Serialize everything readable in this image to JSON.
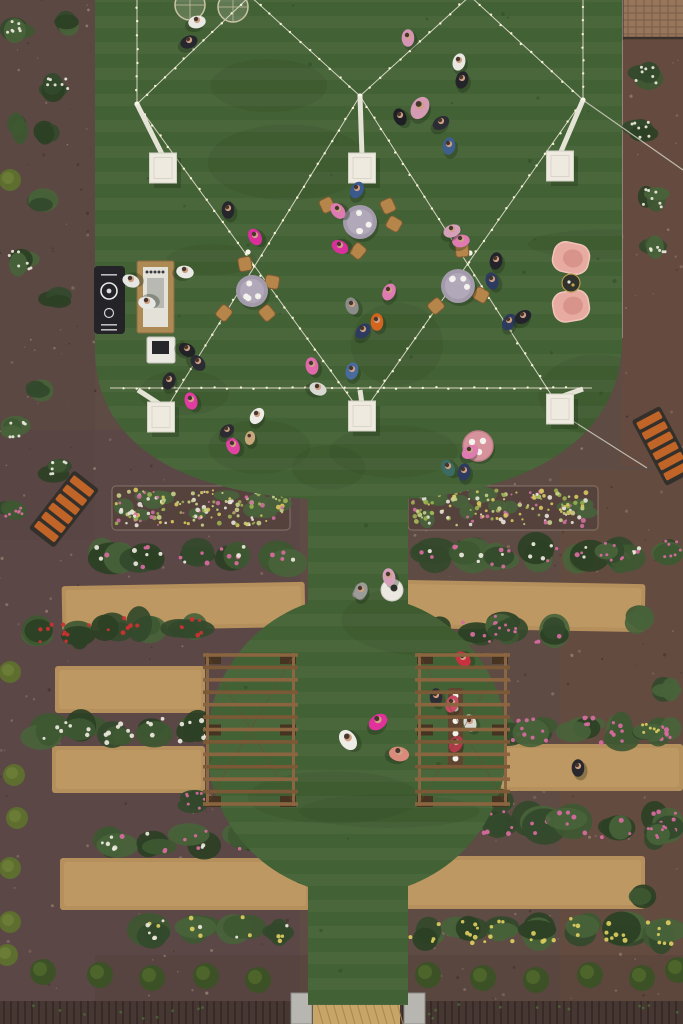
{
  "meta": {
    "type": "aerial-photograph",
    "description": "Overhead drone view of a garden party: a turf lawn strung with criss-crossing string lights and white pedestal boxes, guests around draped tables, a bar, pink lounge chairs, terraced rose beds with tan planter strips, a circular lawn flanked by two wooden pergolas, orange benches and a dark brick road at the bottom."
  },
  "palette": {
    "mulch": "#5e4b44",
    "mulch_speckle1": "#82695e",
    "mulch_speckle2": "#46352f",
    "mulch_speckle3": "#937c70",
    "lawn": "#42613364",
    "lawn_base": "#426134",
    "lawn_stripe": "#ffffff",
    "lawn_blotch": "#14280f",
    "tan_bed": "#b5905c",
    "tan_bed_hi": "#c7a068",
    "soil_dark": "#55423c",
    "bed_edge": "#cabfa8",
    "brick": "#97765c",
    "brick_line": "#7a5c47",
    "road": "#473733",
    "road_line": "#382b27",
    "ramp": "#c7a468",
    "pillar": "#b7b6b0",
    "bush_g1": "#33492b",
    "bush_g2": "#3e5832",
    "bush_g3": "#2b4024",
    "bush_g4": "#486339",
    "shrub_ball": "#3c5226",
    "shrub_ball_hi": "#50682c",
    "shrub_yg": "#5d6e2f",
    "light_line": "#eee9d8",
    "bulb": "#fff8dc",
    "wire": "#d8d5c8",
    "box_fill": "#eeeadf",
    "box_edge": "#d3d0c4",
    "wood": "#7c5936",
    "wood_rail": "#8a6742",
    "wood_dark": "#463321",
    "chair_tan": "#b5854a",
    "chair_edge": "#7d5a33",
    "cloth_gray": "#a39bac",
    "cloth_gray_hi": "#b4acbd",
    "pink_chair": "#e7aba1",
    "pink_chair_in": "#d8938a",
    "pink_chair_rim": "#f2c4ba",
    "pink_table": "#d7939c",
    "pink_table_edge": "#c47f8b",
    "bench_slat": "#c06428",
    "bench_frame": "#33302c",
    "bar_black": "#232328",
    "bar_wood": "#ad8954",
    "bar_white": "#e3e1d8",
    "white": "#eae8e0",
    "skin": "#cfa083",
    "hair": "#2e241e",
    "shadow": "#1c2c16"
  },
  "scene": {
    "canvas": {
      "w": 683,
      "h": 1024
    },
    "tints": [
      [
        0,
        0,
        95,
        540,
        "#5a4540",
        0.5
      ],
      [
        0,
        430,
        300,
        594,
        "#55434a",
        0.35
      ],
      [
        560,
        470,
        123,
        554,
        "#6d4c3c",
        0.4
      ],
      [
        622,
        36,
        61,
        430,
        "#6d4a3a",
        0.45
      ],
      [
        95,
        955,
        588,
        69,
        "#4e3b36",
        0.3
      ]
    ],
    "brick_patch": [
      622,
      0,
      61,
      38
    ],
    "road": [
      0,
      1001,
      683,
      23
    ],
    "ramp": [
      313,
      1003,
      87,
      21
    ],
    "pillars": [
      [
        291,
        993,
        21,
        31
      ],
      [
        404,
        993,
        21,
        31
      ]
    ],
    "lawn": {
      "top_path": "M 95,-10 L 622,-10 L 622,340 C 622,432 540,490 405,499 L 310,499 C 180,492 97,444 95,352 Z",
      "walk_rect": [
        308,
        470,
        100,
        535
      ],
      "circle": [
        357,
        745,
        150
      ]
    },
    "curb_lines": [
      [
        622,
        0,
        622,
        338
      ]
    ],
    "tan_strips_format": "[x,y,w,h,rotDeg]",
    "tan_strips": [
      [
        62,
        584,
        243,
        45,
        -1
      ],
      [
        55,
        666,
        150,
        47,
        0
      ],
      [
        52,
        746,
        153,
        47,
        0
      ],
      [
        60,
        858,
        250,
        52,
        0
      ],
      [
        398,
        582,
        247,
        48,
        1
      ],
      [
        472,
        744,
        211,
        47,
        0
      ],
      [
        400,
        856,
        245,
        53,
        0
      ]
    ],
    "flower_strips": [
      [
        112,
        486,
        178,
        44
      ],
      [
        408,
        486,
        190,
        44
      ]
    ],
    "flower_colors": [
      "#e9e6da",
      "#d9c95e",
      "#cf6fa0",
      "#9ab050",
      "#c8d08a"
    ],
    "bush_rows_format": "[x,y,w,h,[flowerColors]]",
    "bush_rows": [
      [
        85,
        533,
        215,
        45,
        [
          "#d66a9e",
          "#e9e6da"
        ]
      ],
      [
        405,
        533,
        235,
        47,
        [
          "#d66a9e",
          "#e9e6da"
        ]
      ],
      [
        18,
        596,
        185,
        66,
        [
          "#c93131"
        ]
      ],
      [
        420,
        596,
        145,
        64,
        [
          "#d66a9e"
        ]
      ],
      [
        28,
        710,
        185,
        40,
        [
          "#e9e6da"
        ]
      ],
      [
        480,
        710,
        200,
        40,
        [
          "#d66a9e"
        ]
      ],
      [
        95,
        818,
        210,
        44,
        [
          "#d66a9e",
          "#e9e6da"
        ]
      ],
      [
        475,
        795,
        205,
        58,
        [
          "#d66a9e"
        ]
      ],
      [
        130,
        906,
        175,
        50,
        [
          "#d9c95e",
          "#e9e6da"
        ]
      ],
      [
        400,
        903,
        280,
        55,
        [
          "#d9c95e"
        ]
      ]
    ],
    "plants_format": "[x,y,flowerType w|p|y|r|n]",
    "plants": [
      [
        66,
        22,
        "n"
      ],
      [
        57,
        86,
        "w"
      ],
      [
        18,
        28,
        "w"
      ],
      [
        14,
        128,
        "n"
      ],
      [
        48,
        133,
        "n"
      ],
      [
        47,
        202,
        "n"
      ],
      [
        20,
        260,
        "w"
      ],
      [
        55,
        300,
        "n"
      ],
      [
        40,
        390,
        "n"
      ],
      [
        15,
        430,
        "w"
      ],
      [
        55,
        470,
        "w"
      ],
      [
        12,
        510,
        "p"
      ],
      [
        645,
        75,
        "w"
      ],
      [
        640,
        130,
        "w"
      ],
      [
        652,
        198,
        "w"
      ],
      [
        655,
        243,
        "w"
      ],
      [
        612,
        552,
        "p"
      ],
      [
        672,
        550,
        "p"
      ],
      [
        640,
        620,
        "n"
      ],
      [
        668,
        690,
        "n"
      ],
      [
        650,
        730,
        "y"
      ],
      [
        655,
        835,
        "p"
      ],
      [
        640,
        900,
        "n"
      ],
      [
        195,
        802,
        "p"
      ],
      [
        495,
        805,
        "p"
      ],
      [
        505,
        632,
        "p"
      ]
    ],
    "yg_shrubs": [
      [
        10,
        180
      ],
      [
        10,
        672
      ],
      [
        14,
        775
      ],
      [
        17,
        818
      ],
      [
        10,
        868
      ],
      [
        10,
        922
      ],
      [
        7,
        955
      ]
    ],
    "shrub_balls": [
      [
        43,
        972
      ],
      [
        100,
        975
      ],
      [
        152,
        978
      ],
      [
        206,
        976
      ],
      [
        258,
        980
      ],
      [
        428,
        975
      ],
      [
        483,
        978
      ],
      [
        536,
        980
      ],
      [
        590,
        975
      ],
      [
        642,
        978
      ],
      [
        678,
        970
      ]
    ],
    "lights": {
      "segments": [
        [
          137,
          -6,
          137,
          104
        ],
        [
          583,
          -6,
          583,
          100
        ],
        [
          137,
          104,
          250,
          -4
        ],
        [
          250,
          -4,
          360,
          96
        ],
        [
          360,
          96,
          470,
          -4
        ],
        [
          470,
          -4,
          583,
          100
        ],
        [
          137,
          104,
          362,
          414
        ],
        [
          360,
          96,
          163,
          414
        ],
        [
          360,
          96,
          561,
          410
        ],
        [
          583,
          100,
          362,
          414
        ],
        [
          110,
          388,
          592,
          388
        ]
      ],
      "wires": [
        [
          583,
          100,
          683,
          170
        ],
        [
          565,
          416,
          647,
          468
        ]
      ],
      "junctions": [
        [
          137,
          104
        ],
        [
          360,
          96
        ],
        [
          583,
          100
        ],
        [
          248,
          252
        ],
        [
          470,
          253
        ]
      ],
      "boxes_format": "[cx,cy,strutX,strutY]",
      "boxes": [
        [
          163,
          168,
          137,
          104
        ],
        [
          362,
          168,
          360,
          96
        ],
        [
          560,
          166,
          583,
          100
        ],
        [
          161,
          417,
          138,
          390
        ],
        [
          362,
          416,
          360,
          390
        ],
        [
          560,
          409,
          583,
          389
        ]
      ]
    },
    "furniture": {
      "bar": {
        "black_table": [
          94,
          266,
          31,
          68
        ],
        "counter": [
          137,
          261,
          37,
          72
        ],
        "cart": [
          147,
          337,
          28,
          26
        ]
      },
      "glass_tables": [
        [
          190,
          5,
          15
        ],
        [
          233,
          7,
          15
        ]
      ],
      "dining_tables": [
        {
          "x": 360,
          "y": 222,
          "r": 17,
          "chairs": [
            [
              327,
              205,
              -25
            ],
            [
              388,
              206,
              155
            ],
            [
              394,
              224,
              120
            ],
            [
              358,
              251,
              40
            ]
          ]
        },
        {
          "x": 252,
          "y": 291,
          "r": 16,
          "chairs": [
            [
              245,
              264,
              -10
            ],
            [
              224,
              313,
              -140
            ],
            [
              267,
              313,
              140
            ],
            [
              272,
              282,
              100
            ]
          ]
        },
        {
          "x": 458,
          "y": 286,
          "r": 17,
          "chairs": [
            [
              462,
              250,
              -5
            ],
            [
              436,
              306,
              -130
            ],
            [
              481,
              295,
              120
            ]
          ]
        }
      ],
      "pink_chairs": [
        [
          571,
          258,
          12
        ],
        [
          571,
          306,
          -10
        ]
      ],
      "side_table": [
        571,
        283,
        9
      ],
      "cocktail_table": [
        478,
        446,
        15
      ],
      "white_table": [
        392,
        590,
        11
      ],
      "gray_chair": [
        360,
        592
      ],
      "benches_format": "[cx,cy,rotDeg]",
      "benches": [
        [
          64,
          509,
          38
        ],
        [
          663,
          446,
          -28
        ]
      ]
    },
    "pergolas": [
      {
        "x": 205,
        "y": 653,
        "w": 91,
        "h": 153,
        "rungs": 13
      },
      {
        "x": 417,
        "y": 653,
        "w": 91,
        "h": 153,
        "rungs": 13,
        "table": [
          448,
          688,
          15,
          78
        ]
      }
    ],
    "people_format": "[x,y,bodyColor,rotDeg,scale]",
    "people": [
      [
        197,
        22,
        "#eae8e2",
        80,
        1
      ],
      [
        189,
        42,
        "#26262e",
        70,
        1
      ],
      [
        408,
        38,
        "#d695b5",
        0,
        1
      ],
      [
        459,
        62,
        "#e9e7e1",
        15,
        1
      ],
      [
        462,
        80,
        "#23232a",
        15,
        1
      ],
      [
        420,
        108,
        "#d69ab4",
        30,
        1.35
      ],
      [
        400,
        117,
        "#1e1e25",
        -20,
        1
      ],
      [
        441,
        123,
        "#2c2c34",
        60,
        1
      ],
      [
        449,
        146,
        "#3e5f8b",
        10,
        1
      ],
      [
        255,
        237,
        "#da2f9b",
        -30,
        1
      ],
      [
        228,
        210,
        "#26262c",
        0,
        1
      ],
      [
        131,
        281,
        "#e6e6e2",
        -70,
        1
      ],
      [
        147,
        303,
        "#e6e6e2",
        -80,
        1
      ],
      [
        185,
        272,
        "#eae9e5",
        100,
        1
      ],
      [
        187,
        350,
        "#222229",
        120,
        1
      ],
      [
        198,
        363,
        "#2b2b33",
        140,
        1
      ],
      [
        169,
        381,
        "#27272d",
        20,
        1
      ],
      [
        191,
        401,
        "#e23ca2",
        -15,
        1
      ],
      [
        338,
        211,
        "#e07ab2",
        -40,
        1
      ],
      [
        340,
        247,
        "#d9309c",
        -60,
        1
      ],
      [
        357,
        190,
        "#3a5a8e",
        30,
        1
      ],
      [
        377,
        322,
        "#d5641e",
        0,
        1
      ],
      [
        352,
        306,
        "#8b8b89",
        -20,
        1
      ],
      [
        389,
        292,
        "#e07ab2",
        25,
        1
      ],
      [
        363,
        331,
        "#2c3b5f",
        45,
        1
      ],
      [
        496,
        261,
        "#23232c",
        10,
        1
      ],
      [
        492,
        281,
        "#2c3b5f",
        -15,
        1
      ],
      [
        509,
        322,
        "#2c3b5f",
        30,
        1
      ],
      [
        523,
        317,
        "#23232c",
        60,
        1
      ],
      [
        461,
        241,
        "#e07ab2",
        80,
        1
      ],
      [
        452,
        231,
        "#d6a0ba",
        70,
        1
      ],
      [
        312,
        366,
        "#e168aa",
        -10,
        1
      ],
      [
        352,
        371,
        "#4a6b9d",
        15,
        1
      ],
      [
        318,
        389,
        "#d9d9d3",
        110,
        1
      ],
      [
        257,
        416,
        "#edece6",
        35,
        1
      ],
      [
        233,
        446,
        "#e242a1",
        -25,
        1
      ],
      [
        250,
        438,
        "#c9a97b",
        10,
        0.8
      ],
      [
        227,
        431,
        "#2b2b31",
        50,
        0.9
      ],
      [
        448,
        468,
        "#3b6b63",
        -30,
        1
      ],
      [
        464,
        472,
        "#2c3b5f",
        10,
        1
      ],
      [
        470,
        452,
        "#e07ab2",
        60,
        1
      ],
      [
        578,
        768,
        "#27272d",
        0,
        1
      ],
      [
        361,
        591,
        "#9b9b97",
        20,
        1
      ],
      [
        389,
        577,
        "#d6a0ba",
        -10,
        1
      ],
      [
        348,
        740,
        "#edece6",
        -35,
        1.25
      ],
      [
        378,
        722,
        "#e1329b",
        55,
        1.15
      ],
      [
        399,
        754,
        "#da8b7b",
        100,
        1.15
      ]
    ],
    "pergola_people": [
      [
        463,
        659,
        "#c93040",
        -45,
        1
      ],
      [
        436,
        697,
        "#2c2c34",
        0,
        1
      ],
      [
        452,
        704,
        "#c94b63",
        20,
        1
      ],
      [
        470,
        723,
        "#d9d9d3",
        -15,
        1
      ],
      [
        456,
        744,
        "#b23b4b",
        30,
        1
      ]
    ]
  }
}
